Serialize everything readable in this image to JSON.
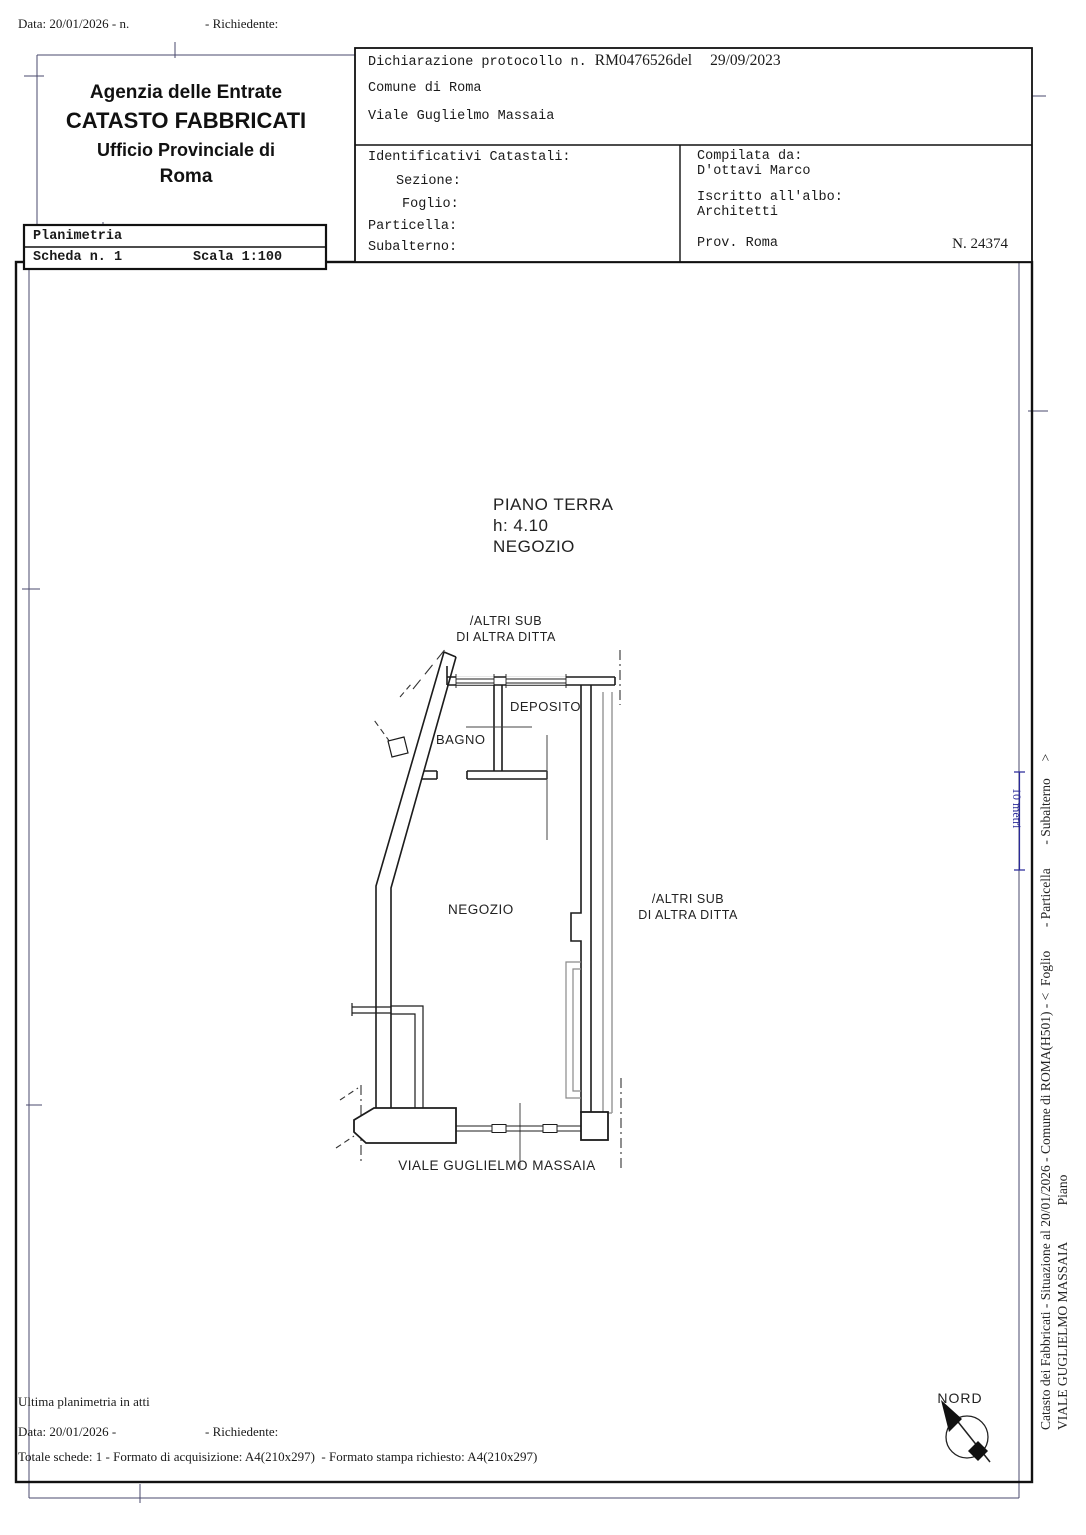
{
  "top_bar": {
    "date_line": "Data: 20/01/2026 - n.",
    "richiedente_label": "- Richiedente:"
  },
  "header": {
    "agency": "Agenzia delle Entrate",
    "registry": "CATASTO FABBRICATI",
    "office": "Ufficio Provinciale di",
    "city": "Roma"
  },
  "planimetria_box": {
    "title": "Planimetria",
    "sheet": "Scheda n. 1",
    "scale": "Scala 1:100"
  },
  "declaration": {
    "protocol_label": "Dichiarazione protocollo n.",
    "protocol_number": "RM0476526del",
    "protocol_date": "29/09/2023",
    "comune": "Comune di Roma",
    "address": "Viale Guglielmo Massaia",
    "identificativi": {
      "title": "Identificativi Catastali:",
      "sezione": "Sezione:",
      "foglio": "Foglio:",
      "particella": "Particella:",
      "subalterno": "Subalterno:"
    },
    "compilata": {
      "label": "Compilata da:",
      "name": "D'ottavi Marco",
      "albo_label": "Iscritto all'albo:",
      "albo": "Architetti",
      "prov": "Prov. Roma",
      "number": "N. 24374"
    }
  },
  "plan": {
    "floor_title": "PIANO TERRA",
    "floor_height": "h: 4.10",
    "floor_use": "NEGOZIO",
    "neighbor_top_line1": "/ALTRI SUB",
    "neighbor_top_line2": "DI ALTRA DITTA",
    "room_bagno": "BAGNO",
    "room_deposito": "DEPOSITO",
    "room_negozio": "NEGOZIO",
    "neighbor_right_line1": "/ALTRI SUB",
    "neighbor_right_line2": "DI ALTRA DITTA",
    "street": "VIALE GUGLIELMO MASSAIA",
    "compass_label": "NORD",
    "scale_bar_label": "10 metri"
  },
  "side_vertical": {
    "line1": "Catasto dei Fabbricati - Situazione al 20/01/2026 - Comune di ROMA(H501) - <  Foglio       - Particella       - Subalterno     >",
    "line2": "VIALE GUGLIELMO MASSAIA           Piano"
  },
  "footer": {
    "line1": "Ultima planimetria in atti",
    "date_line": "Data: 20/01/2026 -",
    "richiedente_label": "- Richiedente:",
    "line3": "Totale schede: 1 - Formato di acquisizione: A4(210x297)  - Formato stampa richiesto: A4(210x297)"
  },
  "colors": {
    "ink": "#1c1c1c",
    "gray_wall": "#9b9b9b",
    "margin_line": "#4a4a6e",
    "scale_blue": "#2a2a9a"
  }
}
